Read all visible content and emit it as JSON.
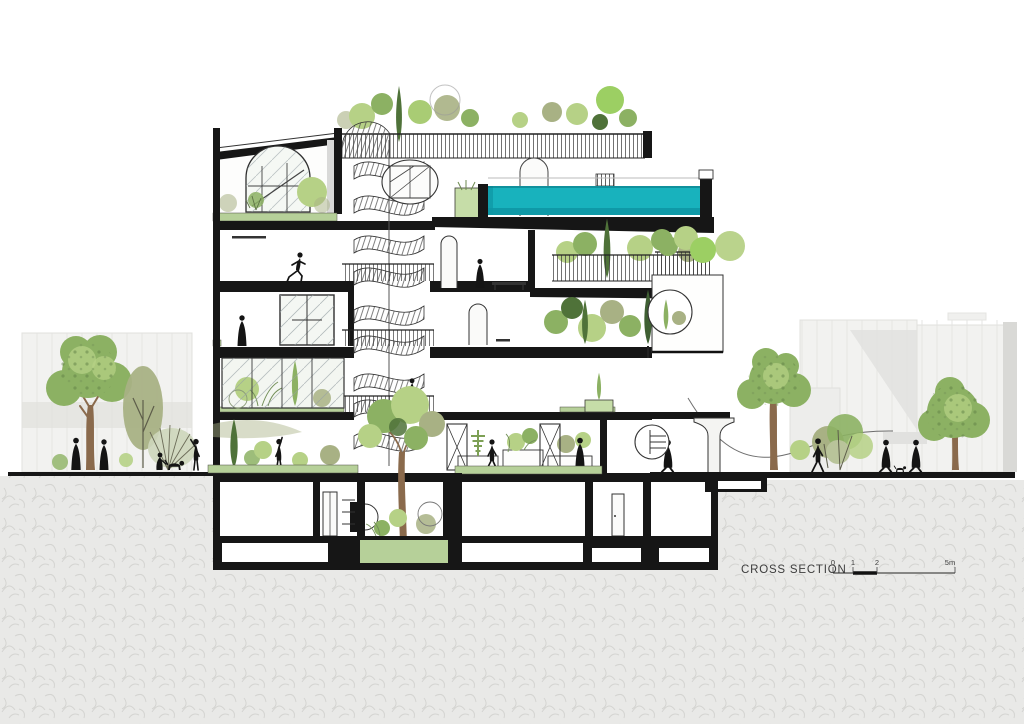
{
  "annotation": {
    "title": "CROSS SECTION",
    "scale_bar": {
      "tick_labels": [
        "0",
        "1",
        "2",
        "5m"
      ]
    }
  },
  "colors": {
    "paper": "#ffffff",
    "ink": "#161616",
    "line": "#2e2e2e",
    "ground": "#e9e9e7",
    "bg_building": "#f2f2f0",
    "bg_building_shade": "#e2e2df",
    "pool_water": "#18b2bd",
    "pool_deep": "#0e96a4",
    "slab_green": "#b6d099",
    "planter_green": "#c6dda8",
    "foliage_light": "#b6d186",
    "foliage_bright": "#9ccf63",
    "foliage_mid": "#8cb163",
    "foliage_olive": "#a8b184",
    "foliage_dark": "#4f7239",
    "trunk": "#8a6a4c",
    "silhouette": "#141414",
    "label_text": "#3d3d3d"
  },
  "scene": {
    "drawing_type": "architectural cross-section rendering",
    "building_features": [
      "rooftop pool",
      "roof garden with railing",
      "spiral staircase",
      "arched windows",
      "planted terraces",
      "winter garden",
      "sunken courtyard tree",
      "basement rooms",
      "street-level colonnade"
    ],
    "context_features": [
      "neighbouring buildings",
      "street trees",
      "pedestrians",
      "dogs"
    ]
  }
}
